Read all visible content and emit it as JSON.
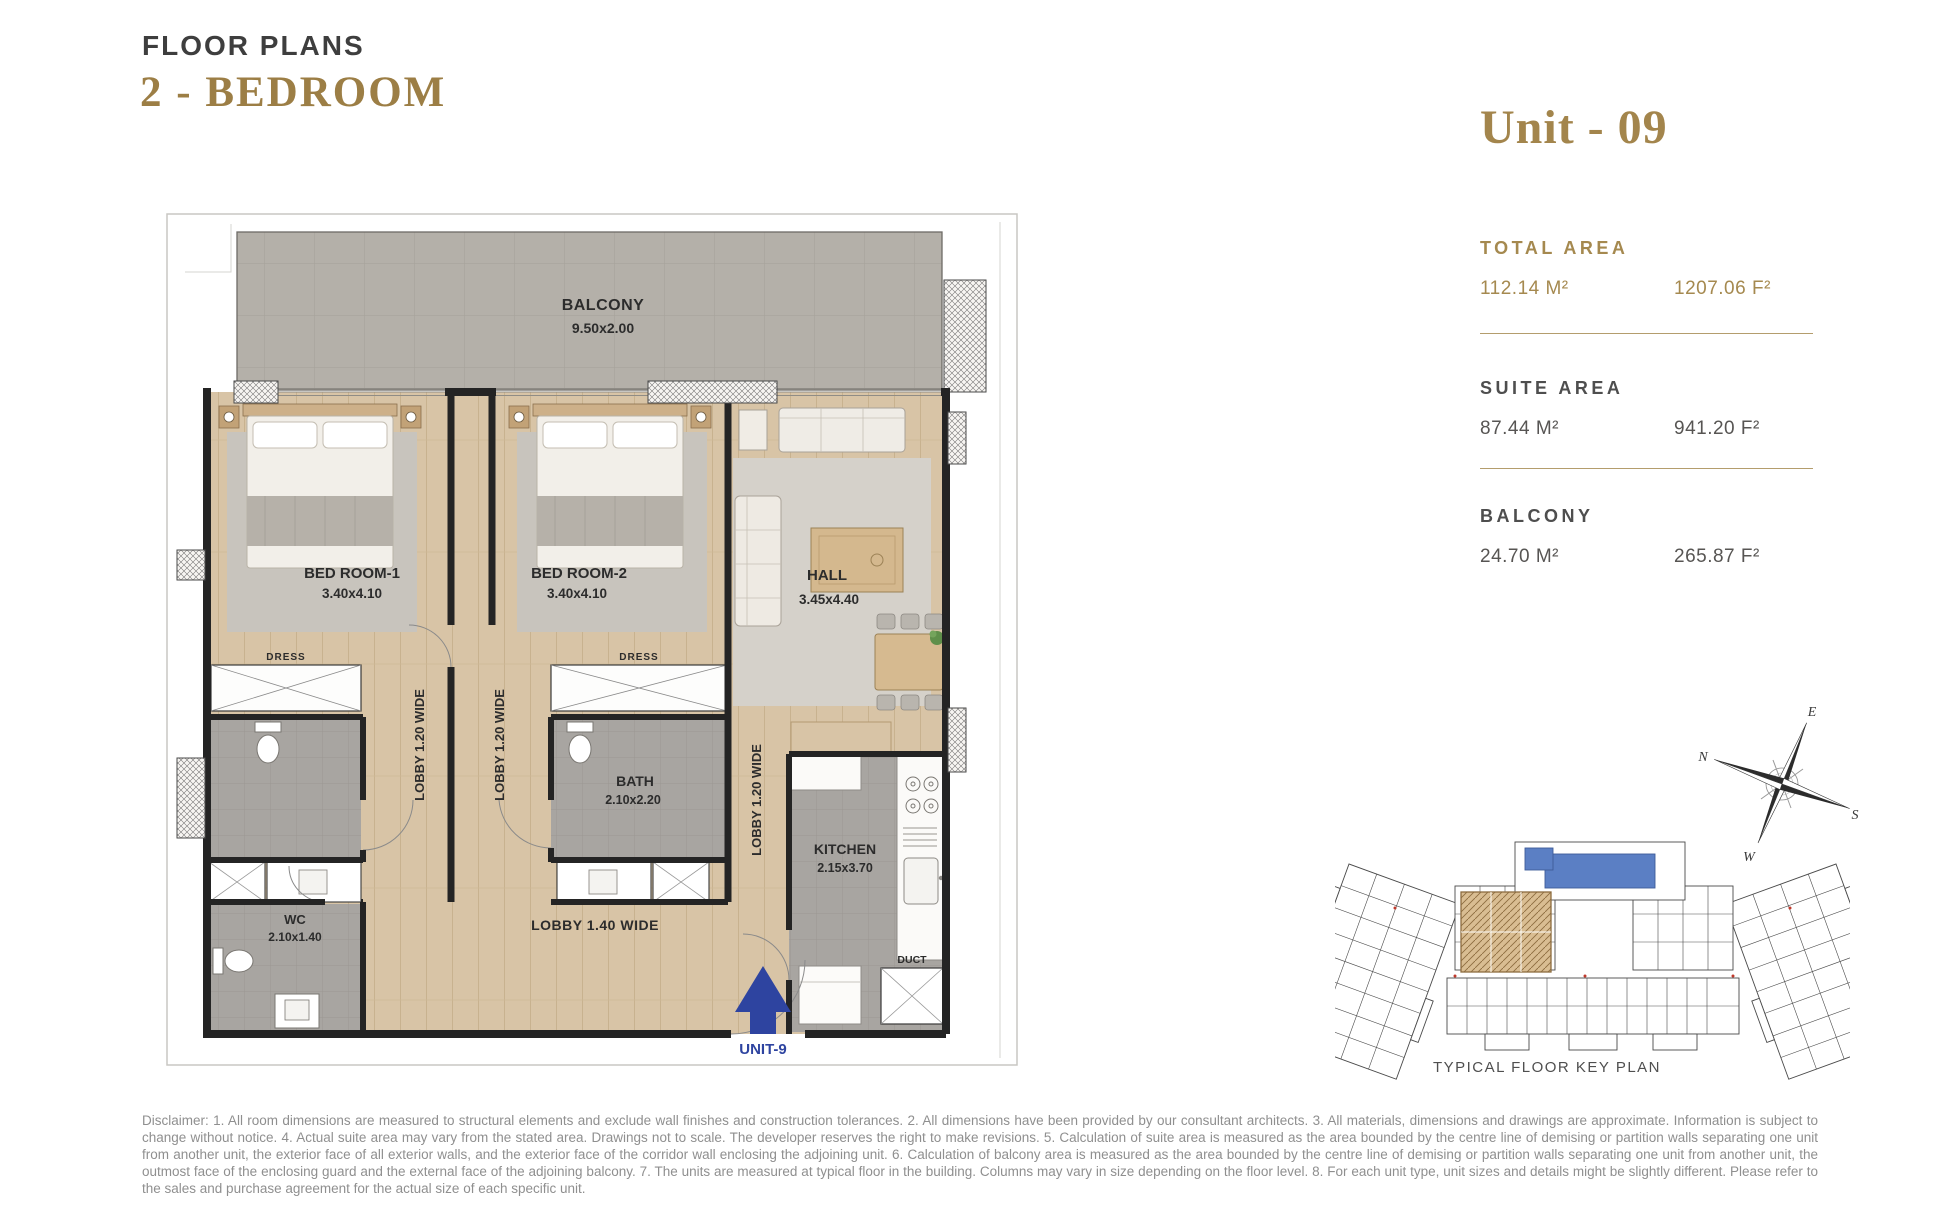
{
  "header": {
    "title": "FLOOR PLANS",
    "subtitle": "2 - BEDROOM"
  },
  "unit_panel": {
    "title": "Unit - 09",
    "sections": [
      {
        "label": "TOTAL AREA",
        "metric": "112.14 M²",
        "imperial": "1207.06 F²"
      },
      {
        "label": "SUITE AREA",
        "metric": "87.44 M²",
        "imperial": "941.20 F²"
      },
      {
        "label": "BALCONY",
        "metric": "24.70 M²",
        "imperial": "265.87 F²"
      }
    ]
  },
  "floor_plan": {
    "balcony": {
      "name": "BALCONY",
      "dims": "9.50x2.00"
    },
    "bedroom1": {
      "name": "BED ROOM-1",
      "dims": "3.40x4.10"
    },
    "bedroom2": {
      "name": "BED ROOM-2",
      "dims": "3.40x4.10"
    },
    "hall": {
      "name": "HALL",
      "dims": "3.45x4.40"
    },
    "bath": {
      "name": "BATH",
      "dims": "2.10x2.20"
    },
    "wc": {
      "name": "WC",
      "dims": "2.10x1.40"
    },
    "kitchen": {
      "name": "KITCHEN",
      "dims": "2.15x3.70"
    },
    "dress_labels": [
      "DRESS",
      "DRESS"
    ],
    "lobby_vertical": [
      "LOBBY 1.20 WIDE",
      "LOBBY 1.20 WIDE",
      "LOBBY 1.20 WIDE"
    ],
    "lobby_horizontal": "LOBBY 1.40 WIDE",
    "duct": "DUCT",
    "entry": "UNIT-9"
  },
  "compass": {
    "e": "E",
    "n": "N",
    "s": "S",
    "w": "W"
  },
  "key_plan": {
    "caption": "TYPICAL FLOOR KEY PLAN"
  },
  "disclaimer": "Disclaimer: 1. All room dimensions are measured to structural elements and exclude wall finishes and construction tolerances. 2. All dimensions have been provided by our consultant architects. 3. All materials, dimensions and drawings are approximate. Information is subject to change without notice. 4. Actual suite area may vary from the stated area. Drawings not to scale. The developer reserves the right to make revisions. 5. Calculation of suite area is measured as the area bounded by the centre line of demising or partition walls separating one unit from another unit, the exterior face of all exterior walls, and the exterior face of the corridor wall enclosing the adjoining unit. 6. Calculation of balcony area is measured as the area bounded by the centre line of demising or partition walls separating one unit from another unit, the outmost face of the enclosing guard and the external face of the adjoining balcony. 7. The units are measured at typical floor in the building. Columns may vary in size depending on the floor level. 8. For each unit type, unit sizes and details might be slightly different. Please refer to the sales and purchase agreement for the actual size of each specific unit.",
  "colors": {
    "gold": "#a3854c",
    "dark_text": "#3e3e3e",
    "plan_label": "#2c2c2c",
    "entry_blue": "#2e44a0",
    "wood_floor": "#d8c4a6",
    "balcony_tile": "#b4b0a9",
    "bath_tile": "#a8a5a1",
    "divider_tan": "#b49d6d",
    "disclaimer_gray": "#8f8f8f",
    "pool_blue": "#5b7fc4",
    "highlight_unit": "#d9bd92"
  }
}
